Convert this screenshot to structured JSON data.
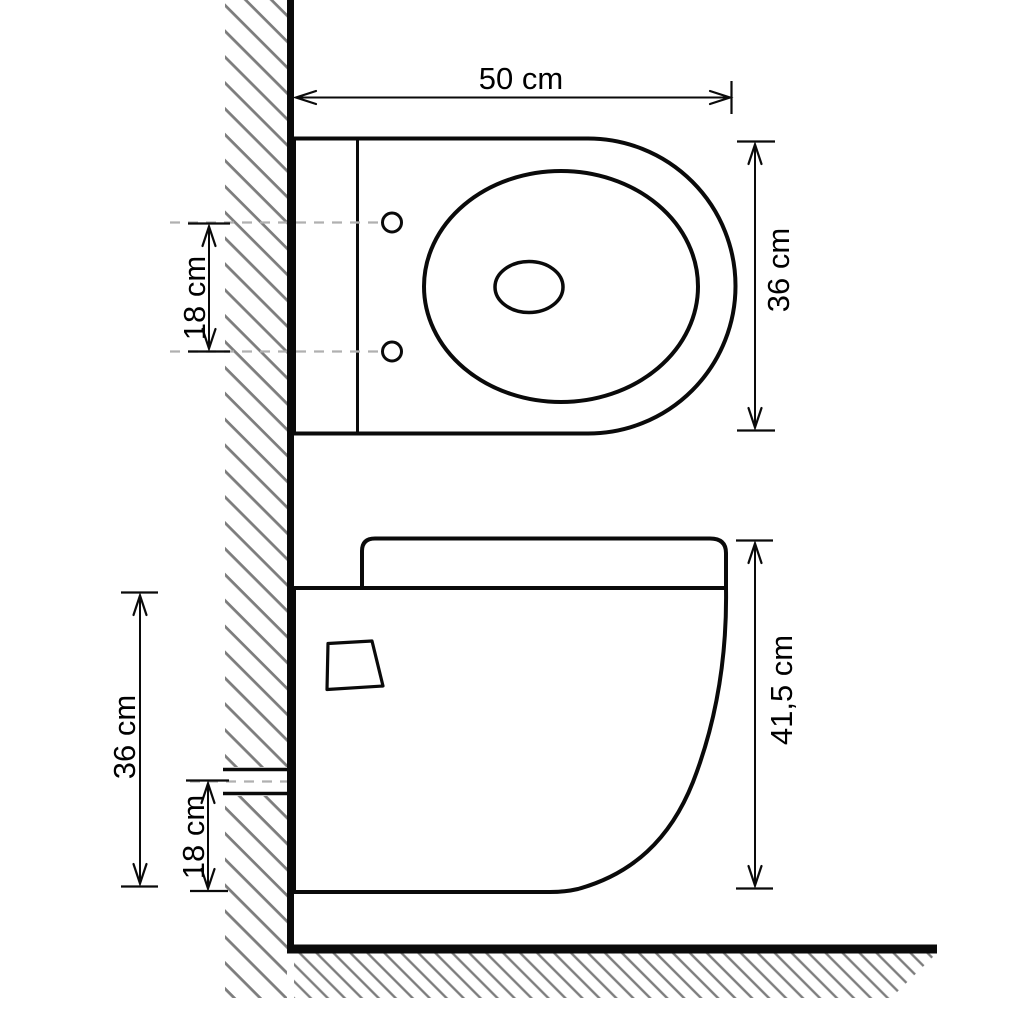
{
  "diagram_type": "technical dimension drawing (wall-hung toilet, top view and side view)",
  "top_view": {
    "width_label": "50 cm",
    "depth_label": "36 cm",
    "bolt_spacing_label": "18 cm"
  },
  "side_view": {
    "total_height_label": "41,5 cm",
    "mount_height_label": "36 cm",
    "outlet_height_label": "18 cm"
  },
  "colors": {
    "background": "#ffffff",
    "line": "#0a0a0a",
    "hatch_gray": "#7d7d7d",
    "dash_gray": "#b0b0b0"
  }
}
